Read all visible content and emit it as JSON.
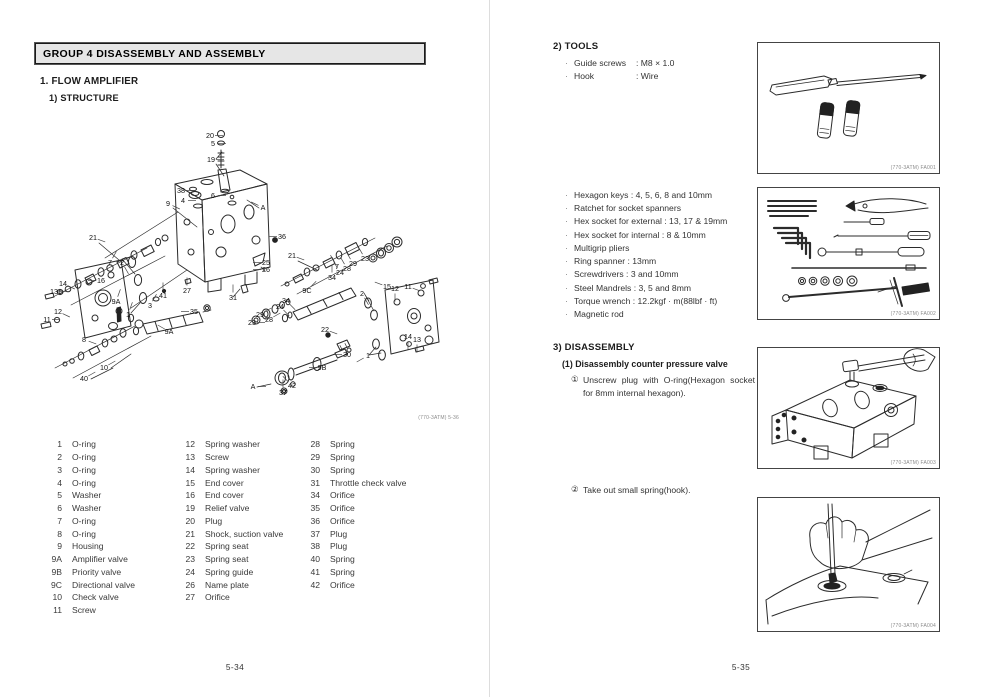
{
  "left": {
    "header": "GROUP 4  DISASSEMBLY AND ASSEMBLY",
    "section1": "1. FLOW AMPLIFIER",
    "sub1": "1) STRUCTURE",
    "diagram_caption": "(770-3ATM) 5-36",
    "page_number": "5-34",
    "parts_columns": [
      [
        [
          "1",
          "O-ring"
        ],
        [
          "2",
          "O-ring"
        ],
        [
          "3",
          "O-ring"
        ],
        [
          "4",
          "O-ring"
        ],
        [
          "5",
          "Washer"
        ],
        [
          "6",
          "Washer"
        ],
        [
          "7",
          "O-ring"
        ],
        [
          "8",
          "O-ring"
        ],
        [
          "9",
          "Housing"
        ],
        [
          "9A",
          "Amplifier valve"
        ],
        [
          "9B",
          "Priority valve"
        ],
        [
          "9C",
          "Directional valve"
        ],
        [
          "10",
          "Check valve"
        ],
        [
          "11",
          "Screw"
        ]
      ],
      [
        [
          "12",
          "Spring washer"
        ],
        [
          "13",
          "Screw"
        ],
        [
          "14",
          "Spring washer"
        ],
        [
          "15",
          "End cover"
        ],
        [
          "16",
          "End cover"
        ],
        [
          "19",
          "Relief valve"
        ],
        [
          "20",
          "Plug"
        ],
        [
          "21",
          "Shock, suction valve"
        ],
        [
          "22",
          "Spring seat"
        ],
        [
          "23",
          "Spring seat"
        ],
        [
          "24",
          "Spring guide"
        ],
        [
          "26",
          "Name plate"
        ],
        [
          "27",
          "Orifice"
        ]
      ],
      [
        [
          "28",
          "Spring"
        ],
        [
          "29",
          "Spring"
        ],
        [
          "30",
          "Spring"
        ],
        [
          "31",
          "Throttle check valve"
        ],
        [
          "34",
          "Orifice"
        ],
        [
          "35",
          "Orifice"
        ],
        [
          "36",
          "Orifice"
        ],
        [
          "37",
          "Plug"
        ],
        [
          "38",
          "Plug"
        ],
        [
          "40",
          "Spring"
        ],
        [
          "41",
          "Spring"
        ],
        [
          "42",
          "Orifice"
        ]
      ]
    ],
    "diagram_callouts": [
      {
        "t": "20",
        "x": 175,
        "y": 26,
        "a": 0
      },
      {
        "t": "5",
        "x": 178,
        "y": 34,
        "a": 0
      },
      {
        "t": "19",
        "x": 176,
        "y": 50,
        "a": 0
      },
      {
        "t": "38",
        "x": 146,
        "y": 81,
        "a": 0
      },
      {
        "t": "4",
        "x": 148,
        "y": 91,
        "a": 0
      },
      {
        "t": "6",
        "x": 178,
        "y": 86,
        "a": 0
      },
      {
        "t": "9",
        "x": 133,
        "y": 94,
        "a": 25
      },
      {
        "t": "A",
        "x": 228,
        "y": 98,
        "a": 205
      },
      {
        "t": "36",
        "x": 247,
        "y": 127,
        "a": 180
      },
      {
        "t": "21",
        "x": 58,
        "y": 128,
        "a": 20
      },
      {
        "t": "7",
        "x": 75,
        "y": 153,
        "a": -60
      },
      {
        "t": "2",
        "x": 87,
        "y": 153,
        "a": 60
      },
      {
        "t": "16",
        "x": 66,
        "y": 171,
        "a": 180
      },
      {
        "t": "14",
        "x": 28,
        "y": 174,
        "a": 25
      },
      {
        "t": "13",
        "x": 19,
        "y": 182,
        "a": 0
      },
      {
        "t": "12",
        "x": 23,
        "y": 202,
        "a": 25
      },
      {
        "t": "11",
        "x": 12,
        "y": 210,
        "a": 0
      },
      {
        "t": "9A",
        "x": 81,
        "y": 192,
        "a": -70
      },
      {
        "t": "1",
        "x": 93,
        "y": 205,
        "a": -70
      },
      {
        "t": "3",
        "x": 115,
        "y": 196,
        "a": -60
      },
      {
        "t": "41",
        "x": 128,
        "y": 186,
        "a": -90
      },
      {
        "t": "27",
        "x": 152,
        "y": 181,
        "a": -90
      },
      {
        "t": "35",
        "x": 159,
        "y": 202,
        "a": 180
      },
      {
        "t": "25",
        "x": 231,
        "y": 153,
        "a": 180
      },
      {
        "t": "26",
        "x": 231,
        "y": 160,
        "a": 180
      },
      {
        "t": "31",
        "x": 198,
        "y": 188,
        "a": -90
      },
      {
        "t": "8",
        "x": 49,
        "y": 230,
        "a": 20
      },
      {
        "t": "10",
        "x": 69,
        "y": 258,
        "a": -30
      },
      {
        "t": "40",
        "x": 49,
        "y": 269,
        "a": -30
      },
      {
        "t": "9A",
        "x": 134,
        "y": 222,
        "a": -150
      },
      {
        "t": "21",
        "x": 257,
        "y": 146,
        "a": 20
      },
      {
        "t": "7",
        "x": 302,
        "y": 157,
        "a": -120
      },
      {
        "t": "24",
        "x": 305,
        "y": 163,
        "a": -120
      },
      {
        "t": "28",
        "x": 312,
        "y": 159,
        "a": -120
      },
      {
        "t": "29",
        "x": 318,
        "y": 154,
        "a": -120
      },
      {
        "t": "23",
        "x": 330,
        "y": 149,
        "a": -120
      },
      {
        "t": "34",
        "x": 297,
        "y": 168,
        "a": -90
      },
      {
        "t": "9C",
        "x": 272,
        "y": 181,
        "a": -45
      },
      {
        "t": "2",
        "x": 327,
        "y": 184,
        "a": 60
      },
      {
        "t": "15",
        "x": 352,
        "y": 177,
        "a": 200
      },
      {
        "t": "12",
        "x": 360,
        "y": 179,
        "a": 90
      },
      {
        "t": "11",
        "x": 373,
        "y": 177,
        "a": 20
      },
      {
        "t": "24",
        "x": 245,
        "y": 197,
        "a": 45
      },
      {
        "t": "34",
        "x": 251,
        "y": 191,
        "a": 45
      },
      {
        "t": "29",
        "x": 225,
        "y": 205,
        "a": -30
      },
      {
        "t": "28",
        "x": 234,
        "y": 210,
        "a": -30
      },
      {
        "t": "23",
        "x": 217,
        "y": 213,
        "a": 0
      },
      {
        "t": "22",
        "x": 290,
        "y": 220,
        "a": 20
      },
      {
        "t": "30",
        "x": 312,
        "y": 245,
        "a": 180
      },
      {
        "t": "9B",
        "x": 287,
        "y": 258,
        "a": 180
      },
      {
        "t": "1",
        "x": 333,
        "y": 246,
        "a": 150
      },
      {
        "t": "14",
        "x": 373,
        "y": 227,
        "a": 90
      },
      {
        "t": "13",
        "x": 382,
        "y": 230,
        "a": 90
      },
      {
        "t": "42",
        "x": 257,
        "y": 276,
        "a": -135
      },
      {
        "t": "37",
        "x": 248,
        "y": 283,
        "a": -90
      },
      {
        "t": "A",
        "x": 218,
        "y": 277,
        "a": 0
      }
    ]
  },
  "right": {
    "bullet": "·",
    "tools_heading": "2) TOOLS",
    "tools_specs": [
      {
        "label": "Guide screws",
        "value": ": M8 × 1.0"
      },
      {
        "label": "Hook",
        "value": ": Wire"
      }
    ],
    "tools_list": [
      "Hexagon keys : 4, 5, 6, 8 and 10mm",
      "Ratchet for socket spanners",
      "Hex socket for external : 13, 17 & 19mm",
      "Hex socket for internal : 8 & 10mm",
      "Multigrip pliers",
      "Ring spanner : 13mm",
      "Screwdrivers : 3 and 10mm",
      "Steel Mandrels : 3, 5 and 8mm",
      "Torque wrench : 12.2kgf · m(88lbf · ft)",
      "Magnetic rod"
    ],
    "disassembly_heading": "3) DISASSEMBLY",
    "disassembly_sub": "(1) Disassembly counter pressure valve",
    "steps": [
      {
        "num": "①",
        "text": "Unscrew plug with O-ring(Hexagon socket for 8mm internal hexagon)."
      },
      {
        "num": "②",
        "text": "Take out small spring(hook)."
      }
    ],
    "figures": [
      {
        "caption": "(770-3ATM) FA001"
      },
      {
        "caption": "(770-3ATM) FA002"
      },
      {
        "caption": "(770-3ATM) FA003"
      },
      {
        "caption": "(770-3ATM) FA004"
      }
    ],
    "page_number": "5-35"
  }
}
